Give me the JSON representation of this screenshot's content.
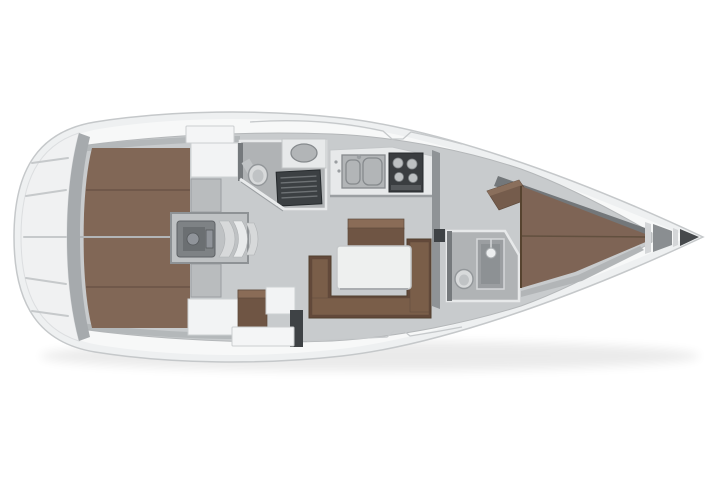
{
  "image": {
    "kind": "sailing-yacht-interior-floor-plan",
    "view": "top-down",
    "orientation": "bow-right-stern-left",
    "background": "#ffffff"
  },
  "colors": {
    "hull-fill": "#eef0f1",
    "hull-stroke": "#c5c8ca",
    "deck-fill": "#f7f8f8",
    "floor-fill": "#c8cbcd",
    "lazarette-fill": "#f0f1f2",
    "bulkhead-fill": "#a6aaad",
    "berth-fill": "#816756",
    "berth-seam": "#6a5347",
    "settee-fill": "#63493a",
    "cushion-fill": "#7a5e49",
    "table-fill": "#eef0ef",
    "counter-fill": "#e7e9ea",
    "stove-fill": "#3a3d40",
    "grate-fill": "#3c4043",
    "fixture-fill": "#d8dadb",
    "head-floor": "#b0b3b5",
    "anchor-fill": "#46494c"
  },
  "areas": [
    {
      "id": "stern-lazarette",
      "furniture": [
        "storage-ribs"
      ]
    },
    {
      "id": "aft-cabin-port",
      "furniture": [
        "double-berth",
        "wardrobe"
      ]
    },
    {
      "id": "aft-cabin-starboard",
      "furniture": [
        "double-berth",
        "wardrobe"
      ]
    },
    {
      "id": "engine-compartment",
      "furniture": [
        "engine-block"
      ]
    },
    {
      "id": "companionway",
      "furniture": [
        "curved-steps"
      ]
    },
    {
      "id": "aft-head",
      "furniture": [
        "toilet",
        "sink",
        "shower-grate"
      ]
    },
    {
      "id": "galley",
      "furniture": [
        "double-sink",
        "stove"
      ]
    },
    {
      "id": "salon",
      "furniture": [
        "u-settee",
        "table",
        "center-bench"
      ]
    },
    {
      "id": "forward-head",
      "furniture": [
        "toilet",
        "shower"
      ]
    },
    {
      "id": "forward-cabin",
      "furniture": [
        "v-berth",
        "shelf"
      ]
    },
    {
      "id": "anchor-locker",
      "furniture": []
    }
  ]
}
